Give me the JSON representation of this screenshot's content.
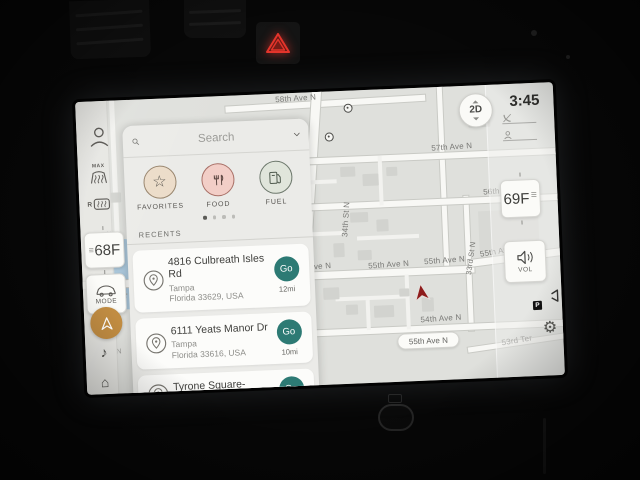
{
  "status": {
    "clock": "3:45"
  },
  "map": {
    "view_toggle_label": "2D",
    "current_street_pill": "55th Ave N",
    "labels": {
      "ave58": "58th Ave N",
      "ave57": "57th Ave N",
      "ave56": "56th Ave N",
      "ave55_a": "55th Ave N",
      "ave55_b": "55th Ave N",
      "ave55_c": "55th Ave N",
      "ave55_d": "55th Ave N",
      "ave54": "54th Ave N",
      "st34": "34th St N",
      "st33": "33rd St N",
      "ter53": "53rd Ter",
      "frag_st_n": "St N",
      "frag_n1": "N",
      "frag_n2": "N"
    }
  },
  "search_panel": {
    "placeholder": "Search",
    "categories": [
      {
        "label": "FAVORITES",
        "glyph": "☆"
      },
      {
        "label": "FOOD"
      },
      {
        "label": "FUEL"
      }
    ],
    "recents_header": "RECENTS",
    "recents": [
      {
        "title": "4816 Culbreath Isles Rd",
        "city": "Tampa",
        "region": "Florida 33629, USA",
        "go_label": "Go",
        "distance": "12mi"
      },
      {
        "title": "6111 Yeats Manor Dr",
        "city": "Tampa",
        "region": "Florida 33616, USA",
        "go_label": "Go",
        "distance": "10mi"
      },
      {
        "title": "Tyrone Square- South",
        "go_label": "Go"
      }
    ]
  },
  "sidebar": {
    "max_defrost_label": "MAX",
    "rear_defrost_label": "R",
    "driver_temp": "68",
    "temp_unit": "F",
    "mode_label": "MODE",
    "music_glyph": "♪",
    "home_glyph": "⌂"
  },
  "right_controls": {
    "passenger_temp": "69",
    "temp_unit": "F",
    "volume_label": "VOL",
    "camera_badge": "P",
    "gear_glyph": "⚙"
  },
  "colors": {
    "go_teal": "#2D7A74",
    "nav_active_orange": "#C08A3E",
    "favorites_tan": "#ECDCC9",
    "food_pink": "#F2CEC7",
    "fuel_sage": "#E0E5DB",
    "hazard_red": "#E3342B",
    "position_arrow_red": "#8E1C1C",
    "map_bg": "#DFE0DC"
  }
}
